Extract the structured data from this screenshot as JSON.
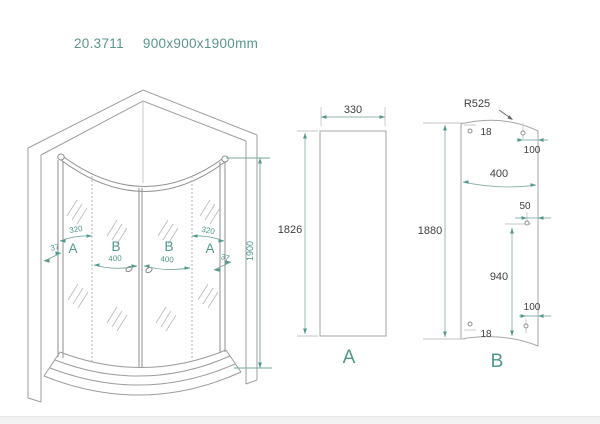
{
  "title": {
    "model": "20.3711",
    "size": "900x900x1900mm"
  },
  "colors": {
    "accent": "#50978C",
    "line": "#9a9a9a",
    "dim_text": "#404040"
  },
  "iso_view": {
    "panel_labels": [
      "A",
      "B",
      "B",
      "A"
    ],
    "dim_37_left": "37",
    "dim_320_left": "320",
    "dim_400_left": "400",
    "dim_400_right": "400",
    "dim_320_right": "320",
    "dim_37_right": "37",
    "dim_height": "1900"
  },
  "panel_a": {
    "label": "A",
    "dim_width": "330",
    "dim_height": "1826"
  },
  "panel_b": {
    "label": "B",
    "dim_radius": "R525",
    "dim_top_hole": "18",
    "dim_top_right_hole": "100",
    "dim_width": "400",
    "dim_mid_hole": "50",
    "dim_hole_height": "940",
    "dim_bottom_right_hole": "100",
    "dim_bottom_hole": "18",
    "dim_height": "1880"
  }
}
